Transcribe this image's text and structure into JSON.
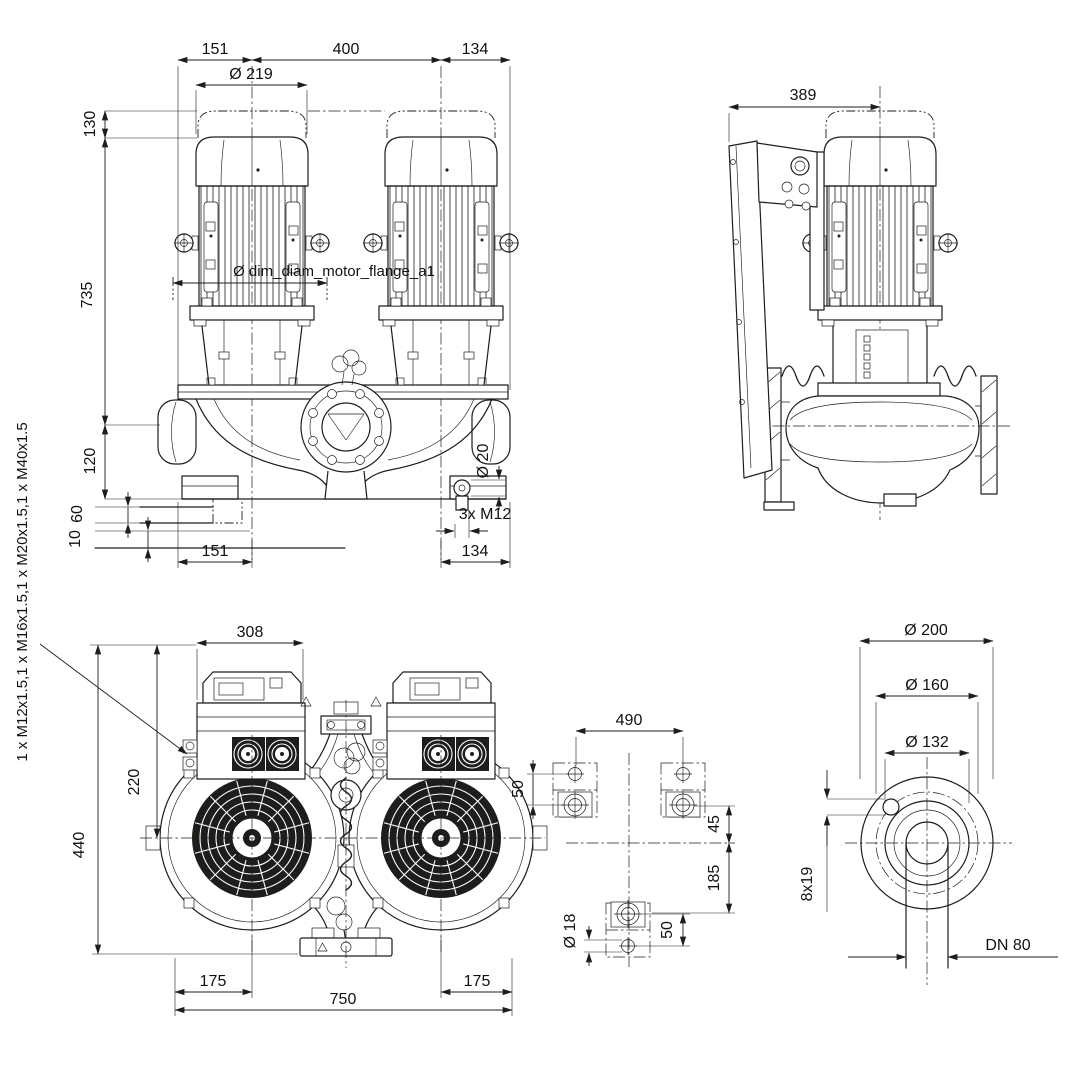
{
  "colors": {
    "ink": "#1d1d1b",
    "background": "#ffffff"
  },
  "front_view": {
    "dim_width_left": "151",
    "dim_width_center": "400",
    "dim_width_right": "134",
    "dim_motor_diameter": "Ø 219",
    "dim_height_cap": "130",
    "dim_height_motor_to_axis": "735",
    "motor_flange_label": "Ø dim_diam_motor_flange_a1",
    "dim_axis_to_base": "120",
    "dim_foot_height": "60",
    "dim_shim_height": "10",
    "dim_width_left_bottom": "151",
    "dim_width_right_bottom": "134",
    "dim_drain_diameter": "Ø 20",
    "dim_drain_thread": "3x M12"
  },
  "side_view": {
    "dim_depth": "389"
  },
  "plan_view": {
    "dim_module_width": "308",
    "dim_axis_offset": "220",
    "dim_depth_total": "440",
    "dim_foot_left": "175",
    "dim_length_total": "750",
    "dim_foot_right": "175",
    "cable_gland_label": "1 x M12x1.5,1 x M16x1.5,1 x M20x1.5,1 x M40x1.5"
  },
  "foundation_view": {
    "dim_bolt_spacing_width": "490",
    "dim_hole_pitch_left": "50",
    "dim_offset_above_axis": "45",
    "dim_offset_below_axis": "185",
    "dim_hole_diameter": "Ø 18",
    "dim_hole_pitch_bottom": "50"
  },
  "flange_view": {
    "dim_outer_diameter": "Ø 200",
    "dim_bolt_circle": "Ø 160",
    "dim_raised_face": "Ø 132",
    "dim_bolt_holes": "8x19",
    "dim_nominal_bore": "DN 80"
  }
}
